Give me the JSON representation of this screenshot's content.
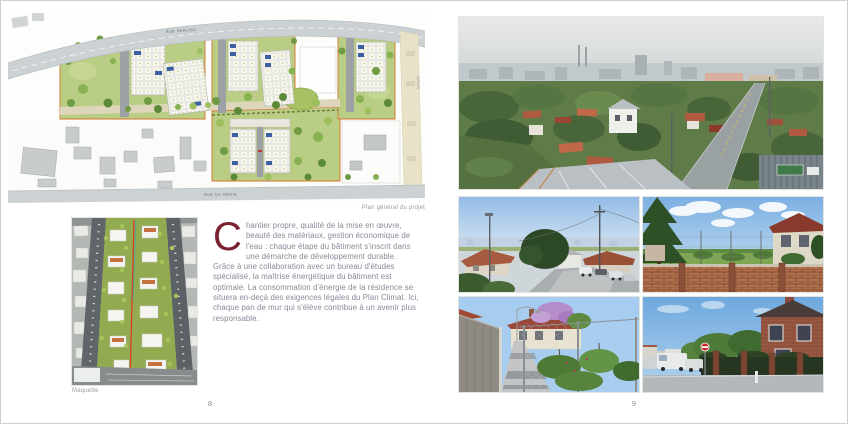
{
  "colors": {
    "accent_burgundy": "#7a2230",
    "body_text": "#8f8597",
    "caption_grey": "#9c9a94",
    "parcel_outline_orange": "#d4722a",
    "plan_road_grey": "#ccd2d4",
    "maquette_red_line": "#d84020"
  },
  "left_page": {
    "page_number": "8",
    "site_plan": {
      "caption": "Plan général du projet",
      "street_top_label": "RUE BERLIOZ",
      "street_bottom_label": "RUE DU GÉNIE",
      "side_label": "JARDIN"
    },
    "maquette": {
      "caption": "Maquette"
    },
    "article": {
      "drop_cap": "C",
      "paragraph_1": "hantier propre, qualité de la mise en œuvre, beauté des matériaux, gestion économique de l'eau : chaque étape du bâtiment s'inscrit dans une démarche de développement durable.",
      "paragraph_2": "Grâce à une collaboration avec un bureau d'études spécialisé, la maîtrise énergétique du bâtiment est optimale. La consommation d'énergie de la résidence se situera en-deçà des exigences légales du Plan Climat. Ici, chaque pan de mur qui s'élève contribue à un avenir plus responsable."
    }
  },
  "right_page": {
    "page_number": "9",
    "photos": {
      "main": "aerial-suburb-panorama",
      "grid": [
        "sunny-street-view-downhill",
        "vacant-lot-behind-brick-wall",
        "garden-alley-with-lilac",
        "street-with-brick-house"
      ]
    }
  }
}
